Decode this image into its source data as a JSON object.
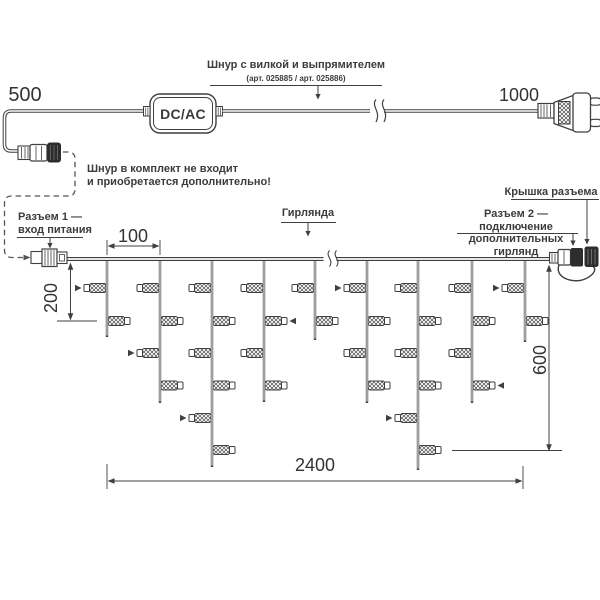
{
  "texts": {
    "cord_title": "Шнур с вилкой и выпрямителем",
    "cord_subtitle": "(арт. 025885 / арт. 025886)",
    "note_line1": "Шнур в комплект не входит",
    "note_line2": "и приобретается дополнительно!",
    "connector1_line1": "Разъем 1 —",
    "connector1_line2": "вход питания",
    "garland_label": "Гирлянда",
    "cap_label": "Крышка разъема",
    "connector2_line1": "Разъем 2 — подключение",
    "connector2_line2": "дополнительных гирлянд",
    "adapter": "DC/AC"
  },
  "dimensions": {
    "cord_left": "500",
    "cord_right": "1000",
    "drop_spacing": "100",
    "drop_short": "200",
    "drop_long": "600",
    "total_length": "2400"
  },
  "colors": {
    "line": "#3f3f3f",
    "dark_fill": "#2d2d2d",
    "text": "#383838"
  },
  "garland": {
    "wire": {
      "x1": 67,
      "x2": 550,
      "y": 259
    },
    "lamp_rows": [
      288,
      321,
      353,
      385.5,
      418,
      450
    ],
    "drops": [
      {
        "x": 107,
        "bottom": 337,
        "lamps": [
          {
            "row": 0,
            "side": "L",
            "arrow": true
          },
          {
            "row": 1,
            "side": "R"
          }
        ]
      },
      {
        "x": 160,
        "bottom": 403,
        "lamps": [
          {
            "row": 0,
            "side": "L"
          },
          {
            "row": 1,
            "side": "R"
          },
          {
            "row": 2,
            "side": "L",
            "arrow": true
          },
          {
            "row": 3,
            "side": "R"
          }
        ]
      },
      {
        "x": 212,
        "bottom": 467,
        "lamps": [
          {
            "row": 0,
            "side": "L"
          },
          {
            "row": 1,
            "side": "R"
          },
          {
            "row": 2,
            "side": "L"
          },
          {
            "row": 3,
            "side": "R"
          },
          {
            "row": 4,
            "side": "L",
            "arrow": true
          },
          {
            "row": 5,
            "side": "R"
          }
        ]
      },
      {
        "x": 264,
        "bottom": 402,
        "lamps": [
          {
            "row": 0,
            "side": "L"
          },
          {
            "row": 1,
            "side": "R",
            "arrow": true
          },
          {
            "row": 2,
            "side": "L"
          },
          {
            "row": 3,
            "side": "R"
          }
        ]
      },
      {
        "x": 315,
        "bottom": 340,
        "lamps": [
          {
            "row": 0,
            "side": "L"
          },
          {
            "row": 1,
            "side": "R"
          }
        ]
      },
      {
        "x": 367,
        "bottom": 403,
        "lamps": [
          {
            "row": 0,
            "side": "L",
            "arrow": true
          },
          {
            "row": 1,
            "side": "R"
          },
          {
            "row": 2,
            "side": "L"
          },
          {
            "row": 3,
            "side": "R"
          }
        ]
      },
      {
        "x": 418,
        "bottom": 470,
        "lamps": [
          {
            "row": 0,
            "side": "L"
          },
          {
            "row": 1,
            "side": "R"
          },
          {
            "row": 2,
            "side": "L"
          },
          {
            "row": 3,
            "side": "R"
          },
          {
            "row": 4,
            "side": "L",
            "arrow": true
          },
          {
            "row": 5,
            "side": "R"
          }
        ]
      },
      {
        "x": 472,
        "bottom": 403,
        "lamps": [
          {
            "row": 0,
            "side": "L"
          },
          {
            "row": 1,
            "side": "R"
          },
          {
            "row": 2,
            "side": "L"
          },
          {
            "row": 3,
            "side": "R",
            "arrow": true
          }
        ]
      },
      {
        "x": 525,
        "bottom": 342,
        "lamps": [
          {
            "row": 0,
            "side": "L",
            "arrow": true
          },
          {
            "row": 1,
            "side": "R"
          }
        ]
      }
    ]
  }
}
